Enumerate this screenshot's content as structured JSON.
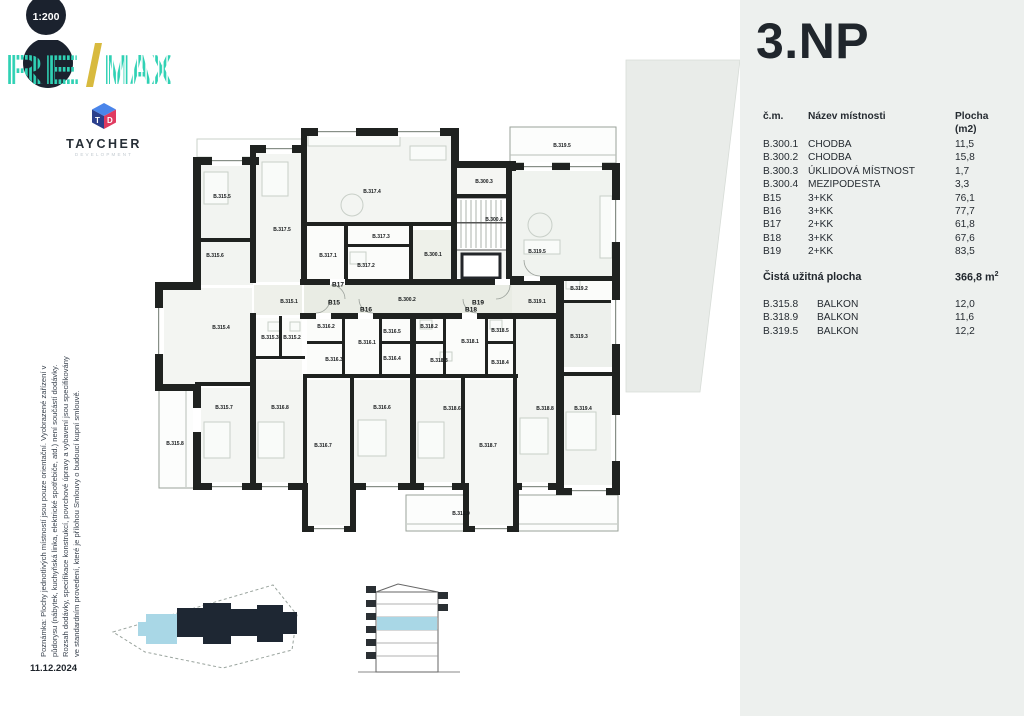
{
  "scale_badge": "1:200",
  "logo": {
    "re": "RE",
    "slash": "/",
    "max": "MAX"
  },
  "developer": {
    "name": "TAYCHER",
    "subtitle": "DEVELOPMENT",
    "cube_t": "T",
    "cube_d": "D"
  },
  "disclaimer": {
    "lines": [
      "Poznámka: Plochy jednotlivých místností jsou pouze orientační. Vyobrazené zařízení v",
      "půdorysu (nábytek, kuchyňská linka, elektrické spotřebiče, atd.) není součástí dodávky.",
      "Rozsah dodávky, specifikace konstrukcí, povrchové úpravy a vybavení jsou specifikovány",
      "ve standardním provedení, které je přílohou Smlouvy o budoucí kupní smlouvě."
    ],
    "date": "11.12.2024"
  },
  "panel": {
    "title": "3.NP",
    "background": "#edf0ee",
    "table": {
      "headers": [
        "č.m.",
        "Název místnosti",
        "Plocha (m2)"
      ],
      "rows": [
        [
          "B.300.1",
          "CHODBA",
          "11,5"
        ],
        [
          "B.300.2",
          "CHODBA",
          "15,8"
        ],
        [
          "B.300.3",
          "ÚKLIDOVÁ MÍSTNOST",
          "1,7"
        ],
        [
          "B.300.4",
          "MEZIPODESTA",
          "3,3"
        ],
        [
          "B15",
          "3+KK",
          "76,1"
        ],
        [
          "B16",
          "3+KK",
          "77,7"
        ],
        [
          "B17",
          "2+KK",
          "61,8"
        ],
        [
          "B18",
          "3+KK",
          "67,6"
        ],
        [
          "B19",
          "2+KK",
          "83,5"
        ]
      ],
      "total_label": "Čistá užitná plocha",
      "total_value": "366,8",
      "total_unit": "m",
      "total_sup": "2",
      "balconies": [
        [
          "B.315.8",
          "BALKON",
          "12,0"
        ],
        [
          "B.318.9",
          "BALKON",
          "11,6"
        ],
        [
          "B.319.5",
          "BALKON",
          "12,2"
        ]
      ]
    }
  },
  "floorplan": {
    "unit_labels": [
      {
        "label": "B15",
        "x": 334,
        "y": 303
      },
      {
        "label": "B16",
        "x": 366,
        "y": 310
      },
      {
        "label": "B17",
        "x": 338,
        "y": 285
      },
      {
        "label": "B18",
        "x": 471,
        "y": 310
      },
      {
        "label": "B19",
        "x": 478,
        "y": 303
      }
    ],
    "room_labels": [
      {
        "label": "B.315.5",
        "x": 222,
        "y": 197
      },
      {
        "label": "B.315.6",
        "x": 215,
        "y": 256
      },
      {
        "label": "B.317.5",
        "x": 282,
        "y": 230
      },
      {
        "label": "B.317.4",
        "x": 372,
        "y": 192
      },
      {
        "label": "B.317.1",
        "x": 328,
        "y": 256
      },
      {
        "label": "B.317.2",
        "x": 366,
        "y": 266
      },
      {
        "label": "B.317.3",
        "x": 381,
        "y": 237
      },
      {
        "label": "B.300.3",
        "x": 484,
        "y": 182
      },
      {
        "label": "B.300.4",
        "x": 494,
        "y": 220
      },
      {
        "label": "B.300.1",
        "x": 433,
        "y": 255
      },
      {
        "label": "B.300.2",
        "x": 407,
        "y": 300
      },
      {
        "label": "B.319.5",
        "x": 562,
        "y": 146
      },
      {
        "label": "B.319.5",
        "x": 537,
        "y": 252
      },
      {
        "label": "B.319.1",
        "x": 537,
        "y": 302
      },
      {
        "label": "B.319.2",
        "x": 579,
        "y": 289
      },
      {
        "label": "B.319.3",
        "x": 579,
        "y": 337
      },
      {
        "label": "B.319.4",
        "x": 583,
        "y": 409
      },
      {
        "label": "B.315.1",
        "x": 289,
        "y": 302
      },
      {
        "label": "B.315.4",
        "x": 221,
        "y": 328
      },
      {
        "label": "B.315.3",
        "x": 270,
        "y": 338
      },
      {
        "label": "B.315.2",
        "x": 292,
        "y": 338
      },
      {
        "label": "B.315.7",
        "x": 224,
        "y": 408
      },
      {
        "label": "B.315.8",
        "x": 175,
        "y": 444
      },
      {
        "label": "B.316.2",
        "x": 326,
        "y": 327
      },
      {
        "label": "B.316.1",
        "x": 367,
        "y": 343
      },
      {
        "label": "B.316.5",
        "x": 392,
        "y": 332
      },
      {
        "label": "B.316.3",
        "x": 334,
        "y": 360
      },
      {
        "label": "B.316.4",
        "x": 392,
        "y": 359
      },
      {
        "label": "B.316.8",
        "x": 280,
        "y": 408
      },
      {
        "label": "B.316.7",
        "x": 323,
        "y": 446
      },
      {
        "label": "B.316.6",
        "x": 382,
        "y": 408
      },
      {
        "label": "B.318.2",
        "x": 429,
        "y": 327
      },
      {
        "label": "B.318.1",
        "x": 470,
        "y": 342
      },
      {
        "label": "B.318.5",
        "x": 500,
        "y": 331
      },
      {
        "label": "B.318.3",
        "x": 439,
        "y": 361
      },
      {
        "label": "B.318.4",
        "x": 500,
        "y": 363
      },
      {
        "label": "B.318.6",
        "x": 452,
        "y": 409
      },
      {
        "label": "B.318.7",
        "x": 488,
        "y": 446
      },
      {
        "label": "B.318.8",
        "x": 545,
        "y": 409
      },
      {
        "label": "B.318.9",
        "x": 461,
        "y": 514
      }
    ]
  },
  "colors": {
    "accent_teal": "#2fd1b4",
    "navy": "#1b222e",
    "gold": "#d8ba3e",
    "highlight_blue": "#a9d7e6",
    "panel_bg": "#edf0ee",
    "wall": "#1f2220"
  }
}
